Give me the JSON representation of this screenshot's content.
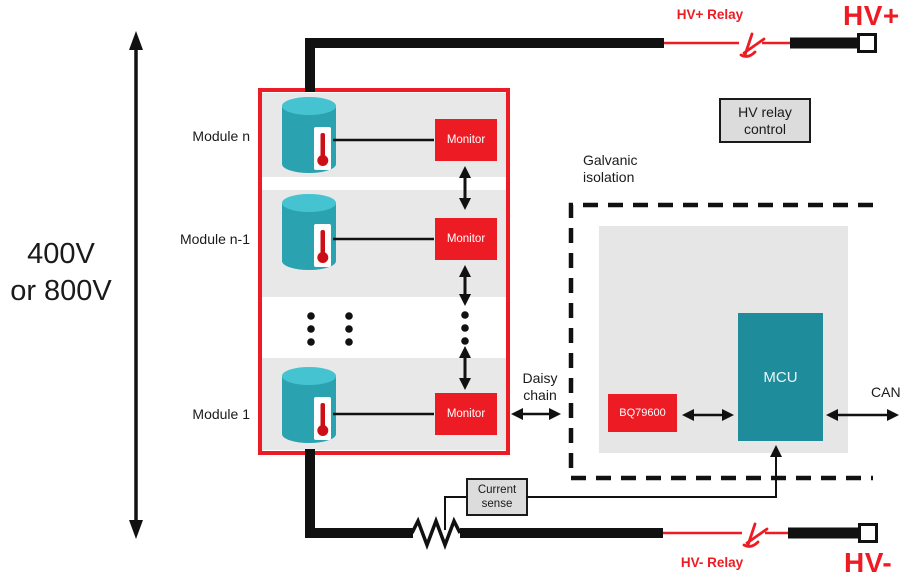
{
  "colors": {
    "red": "#ED1C24",
    "mcu_teal": "#1F8C9C",
    "cell_teal": "#2AA2B0",
    "cell_teal_top": "#45C3D0",
    "module_band_gray": "#E8E8E8",
    "controller_panel_gray": "#E6E6E6",
    "control_box_gray": "#DCDCDC"
  },
  "left": {
    "voltage_line1": "400V",
    "voltage_line2": "or 800V"
  },
  "pack": {
    "modules": [
      {
        "label": "Module n",
        "monitor": "Monitor"
      },
      {
        "label": "Module n-1",
        "monitor": "Monitor"
      },
      {
        "label": "Module 1",
        "monitor": "Monitor"
      }
    ]
  },
  "daisy_chain": {
    "line1": "Daisy",
    "line2": "chain"
  },
  "isolation": {
    "line1": "Galvanic",
    "line2": "isolation"
  },
  "controller": {
    "bq": "BQ79600",
    "mcu": "MCU",
    "spi_line1": "SPI/",
    "spi_line2": "UART",
    "can": "CAN"
  },
  "hv": {
    "plus_relay": "HV+ Relay",
    "plus": "HV+",
    "minus_relay": "HV- Relay",
    "minus": "HV-",
    "relay_control_line1": "HV relay",
    "relay_control_line2": "control"
  },
  "current_sense": {
    "line1": "Current",
    "line2": "sense"
  }
}
